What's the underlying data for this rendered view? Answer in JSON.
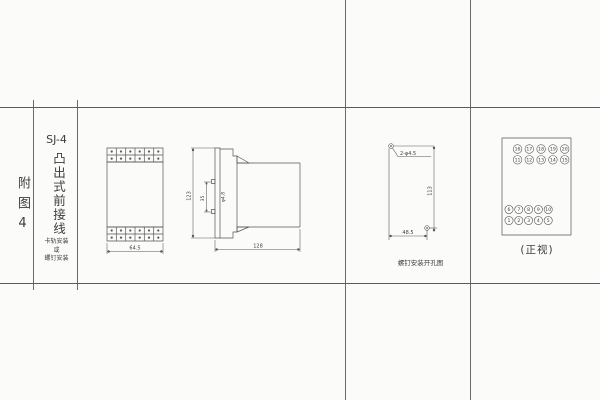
{
  "colors": {
    "paper": "#fbfbf9",
    "ink": "#4c4c4c"
  },
  "title_block": {
    "figure_label": "附图4",
    "model": "SJ-4",
    "title_vertical": "凸出式前接线",
    "subtitle_lines": [
      "卡轨安装",
      "或",
      "螺钉安装"
    ]
  },
  "front_view": {
    "width_dim": "64.5"
  },
  "side_view": {
    "height_dim": "123",
    "depth_dim": "128",
    "inner_dim_a": "35",
    "inner_dim_b": "φ4.8"
  },
  "drill_view": {
    "holes_label": "2-φ4.5",
    "vertical_dim": "113",
    "horizontal_dim": "48.5",
    "caption": "螺钉安装开孔图"
  },
  "terminal_view": {
    "caption": "(正视)",
    "top_rows": [
      [
        "16",
        "17",
        "18",
        "19",
        "20"
      ],
      [
        "11",
        "12",
        "13",
        "14",
        "15"
      ]
    ],
    "bottom_rows": [
      [
        "6",
        "7",
        "8",
        "9",
        "10"
      ],
      [
        "1",
        "2",
        "3",
        "4",
        "5"
      ]
    ]
  }
}
